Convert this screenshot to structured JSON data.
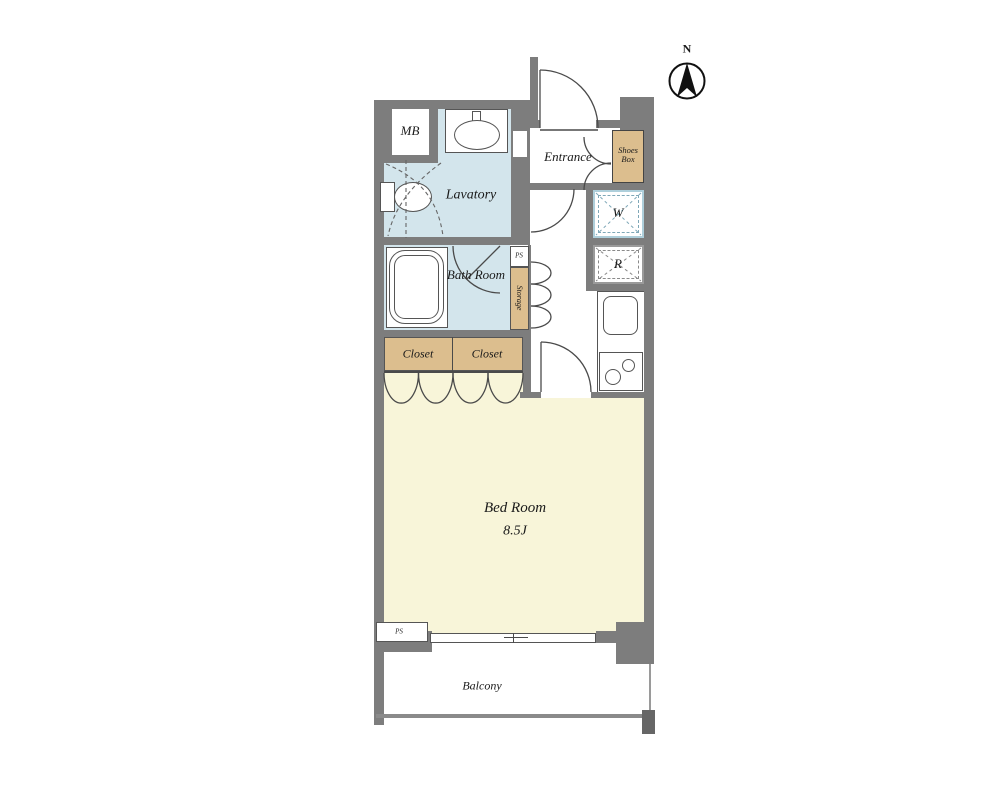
{
  "compass": {
    "label": "N"
  },
  "labels": {
    "mb": "MB",
    "lavatory": "Lavatory",
    "bath_room": "Bath Room",
    "entrance": "Entrance",
    "shoes_box": "Shoes Box",
    "washer": "W",
    "fridge": "R",
    "ps_upper": "PS",
    "storage": "Storage",
    "closet_1": "Closet",
    "closet_2": "Closet",
    "bed_room": "Bed Room",
    "bed_room_size": "8.5J",
    "ps_lower": "PS",
    "balcony": "Balcony"
  },
  "colors": {
    "wall_gray": "#7d7d7d",
    "wet_room_blue": "#d3e5ec",
    "closet_tan": "#dcbe8e",
    "bedroom_cream": "#f8f5d9",
    "line_dark": "#4a4a4a",
    "washer_box_blue": "#7fa8b8"
  }
}
